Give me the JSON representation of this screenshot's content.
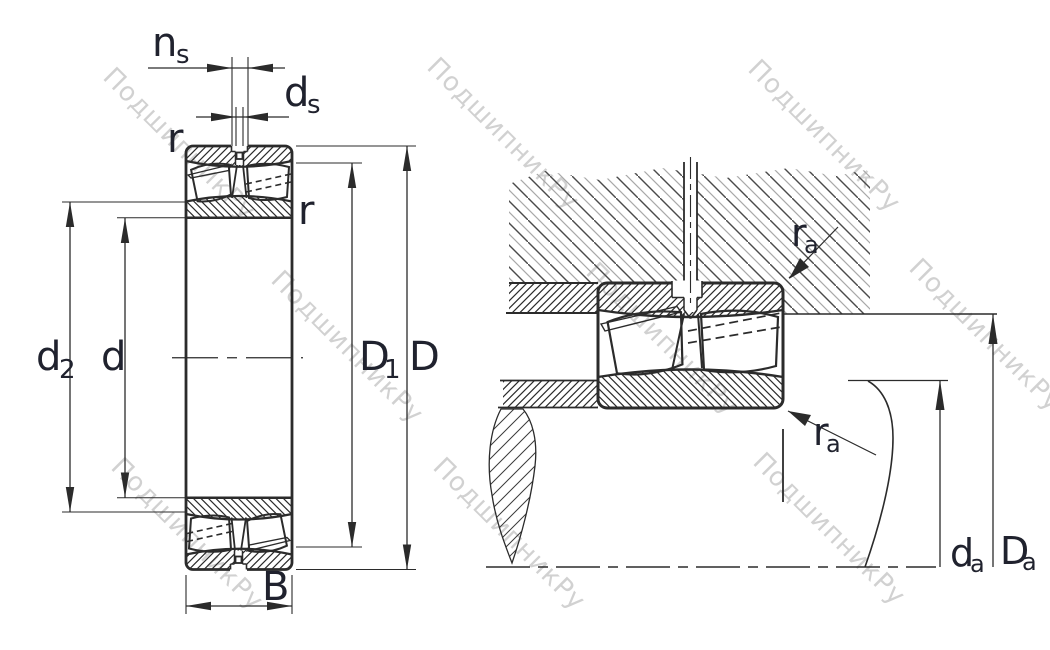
{
  "colors": {
    "line": "#2b2b2b",
    "label": "#20222e",
    "watermark": "#cacaca"
  },
  "watermark": {
    "text": "ПодшипникРу"
  },
  "left_view": {
    "labels": {
      "ns_main": "n",
      "ns_sub": "s",
      "ds_main": "d",
      "ds_sub": "s",
      "r_top": "r",
      "r_side": "r",
      "d2_main": "d",
      "d2_sub": "2",
      "d_main": "d",
      "D1_main": "D",
      "D1_sub": "1",
      "D_main": "D",
      "B": "B"
    }
  },
  "right_view": {
    "labels": {
      "ra_top_main": "r",
      "ra_top_sub": "a",
      "ra_bottom_main": "r",
      "ra_bottom_sub": "a",
      "da_main": "d",
      "da_sub": "a",
      "Da_main": "D",
      "Da_sub": "a"
    }
  }
}
